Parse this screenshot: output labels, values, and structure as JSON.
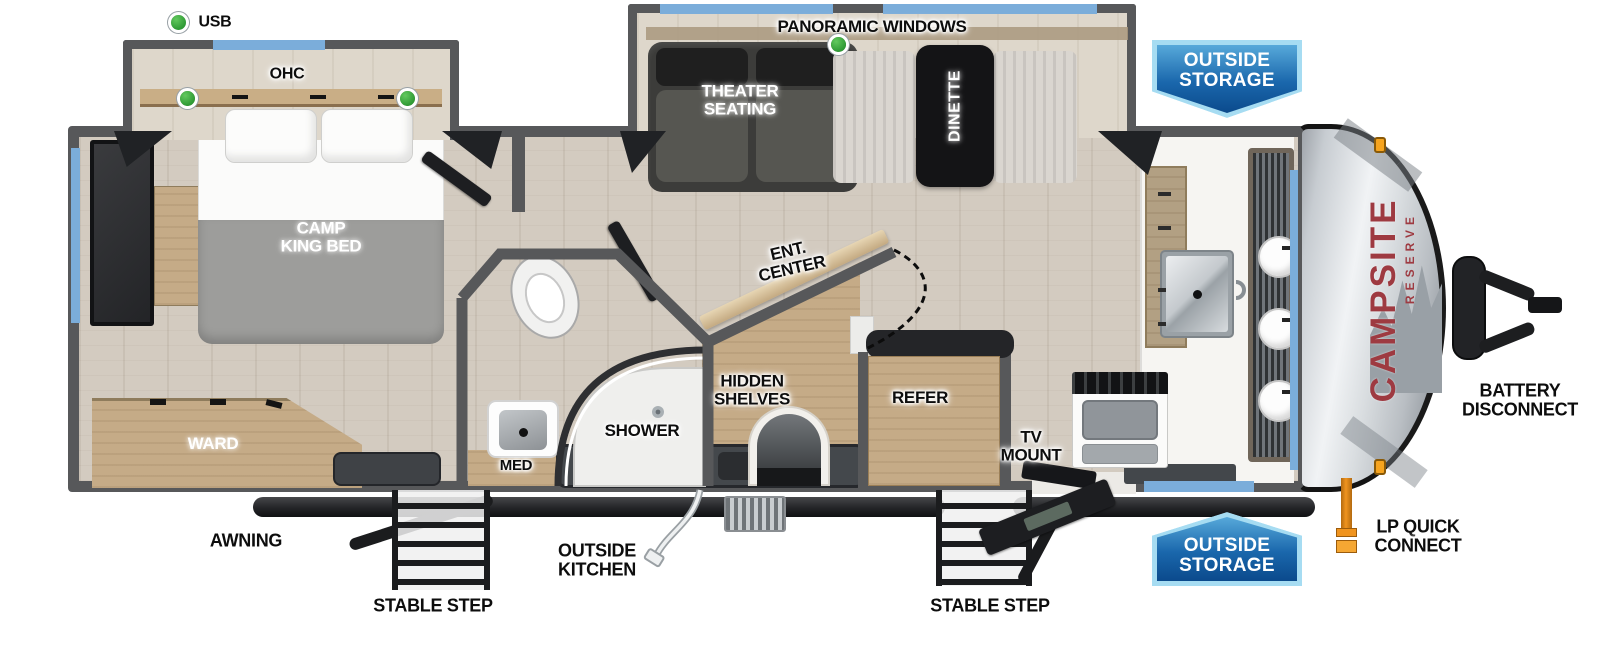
{
  "diagram_type": "travel-trailer-floorplan",
  "brand": {
    "name": "CAMPSITE",
    "series": "RESERVE"
  },
  "badges": {
    "outside_storage": "OUTSIDE\nSTORAGE"
  },
  "labels": {
    "usb": "USB",
    "ohc": "OHC",
    "panoramic_windows": "PANORAMIC WINDOWS",
    "theater_seating": "THEATER\nSEATING",
    "dinette": "DINETTE",
    "camp_king_bed": "CAMP\nKING BED",
    "ward": "WARD",
    "med": "MED",
    "shower": "SHOWER",
    "hidden_shelves": "HIDDEN\nSHELVES",
    "ent_center": "ENT.\nCENTER",
    "refer": "REFER",
    "tv_mount": "TV\nMOUNT",
    "awning": "AWNING",
    "outside_kitchen": "OUTSIDE\nKITCHEN",
    "stable_step_left": "STABLE STEP",
    "stable_step_right": "STABLE STEP",
    "lp_quick_connect": "LP QUICK\nCONNECT",
    "battery_disconnect": "BATTERY\nDISCONNECT"
  },
  "green_markers": [
    "usb",
    "ohc-shelf-left",
    "ohc-shelf-right",
    "panoramic-windows"
  ],
  "colors": {
    "window_blue": "#7badda",
    "wall_gray": "#57585a",
    "badge_border": "#a6dcf2",
    "badge_fill_dark": "#0b4a8c",
    "led_green": "#3cb043",
    "brand_red": "#9e3a41",
    "lp_orange": "#f0941f",
    "floor": "#d3cbc0",
    "cabinet_wood": "#c5ab87",
    "mattress_gray": "#9c9c9a"
  }
}
